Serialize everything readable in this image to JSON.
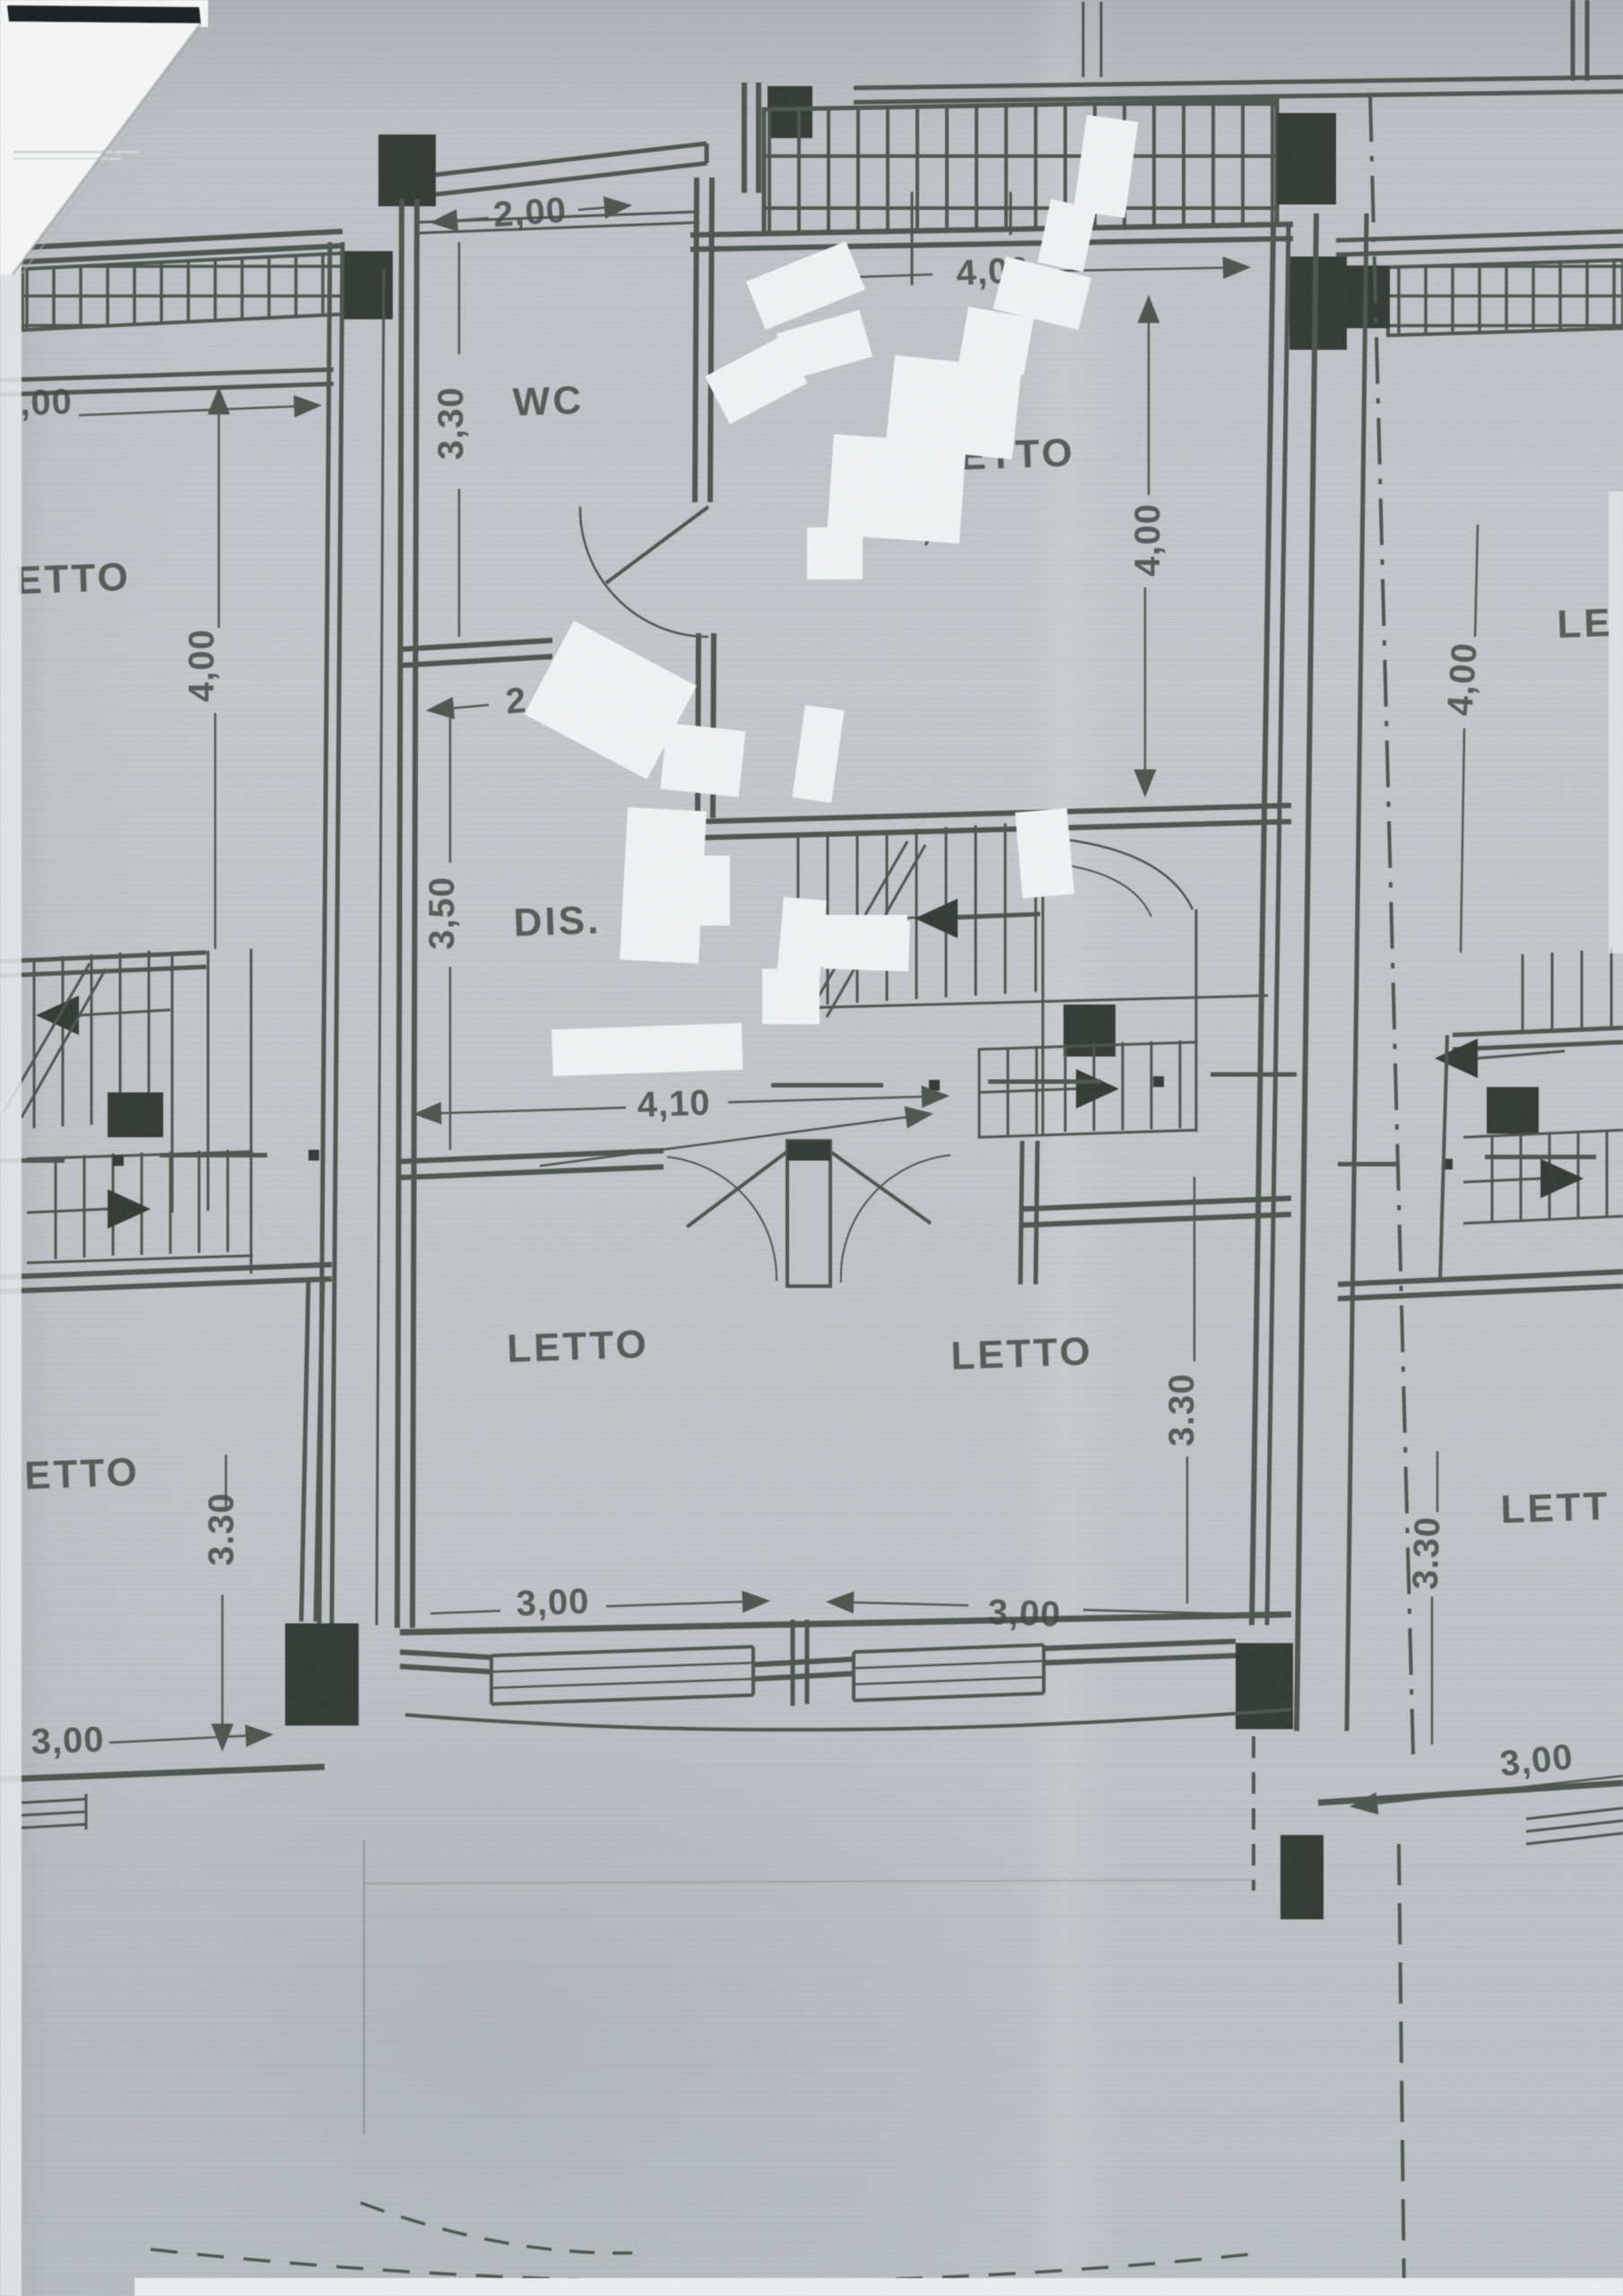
{
  "document": {
    "kind": "scanned floor plan"
  },
  "rooms": {
    "wc": "WC",
    "letto_top": "LETTO",
    "dis": "DIS.",
    "letto_bottom_left": "LETTO",
    "letto_bottom_right": "LETTO",
    "neighbor_left_top": "ETTO",
    "neighbor_left_bottom": "ETTO",
    "neighbor_right_top": "LE",
    "neighbor_right_bottom": "LETT"
  },
  "dimensions": {
    "wc_width": "2,00",
    "wc_height": "3,30",
    "letto_top_width": "4,00",
    "letto_top_height": "4,00",
    "hall_width": "2,00",
    "hall_height": "3,50",
    "dis_width": "4,10",
    "letto_bottom_right_height": "3.30",
    "letto_bottom_left_width": "3,00",
    "letto_bottom_right_width": "3,00",
    "neighbor_left_partial": ",00",
    "neighbor_left_height": "4,00",
    "neighbor_left_bottom_height": "3.30",
    "neighbor_left_width": "3,00",
    "neighbor_right_height": "4,00",
    "neighbor_right_bottom_height": "3.30",
    "neighbor_right_width": "3,00"
  },
  "colors": {
    "ink": "#49514a",
    "black_fill": "#2e352f",
    "paper": "#c6cacd",
    "redaction_white": "#f8f9fa"
  }
}
